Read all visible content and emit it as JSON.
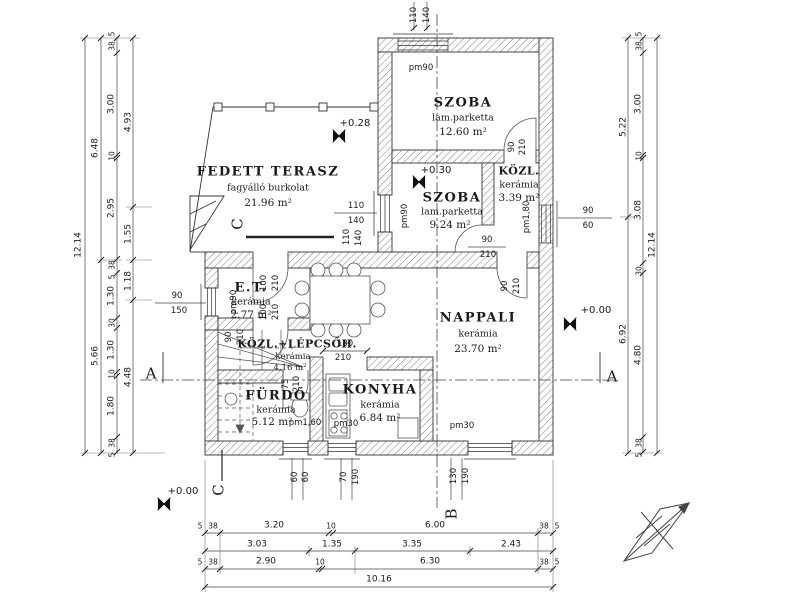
{
  "rooms": [
    {
      "name": "FEDETT TERASZ",
      "finish": "fagyálló burkolat",
      "area": "21.96 m²"
    },
    {
      "name": "SZOBA",
      "finish": "lam.parketta",
      "area": "12.60 m²"
    },
    {
      "name": "KÖZL.",
      "finish": "kerámia",
      "area": "3.39 m²"
    },
    {
      "name": "SZOBA",
      "finish": "lam.parketta",
      "area": "9.24 m²"
    },
    {
      "name": "NAPPALI",
      "finish": "kerámia",
      "area": "23.70 m²"
    },
    {
      "name": "E.T.",
      "finish": "kerámia",
      "area": "2.77 m²"
    },
    {
      "name": "KÖZL.+LÉPCSŐH.",
      "finish": "kerámia",
      "area": "4.16 m²"
    },
    {
      "name": "FÜRDŐ",
      "finish": "kerámia",
      "area": "5.12 m²"
    },
    {
      "name": "KONYHA",
      "finish": "kerámia",
      "area": "6.84 m²"
    }
  ],
  "levels": {
    "terasz": "+0.28",
    "szoba": "+0.30",
    "ground_a": "+0.00",
    "ground_b": "+0.00"
  },
  "sections": {
    "a": "A",
    "b": "B",
    "c": "C"
  },
  "dims": {
    "v_total": "12.14",
    "left2": [
      "6.48",
      "5.66"
    ],
    "left3": [
      "5",
      "38",
      "3.00",
      "10",
      "2.95",
      "38",
      "5",
      "1.30",
      "30",
      "1.30",
      "10",
      "1.80",
      "38",
      "5"
    ],
    "left4": [
      "4.93",
      "1.55",
      "1.18",
      "4.48"
    ],
    "right1": [
      "5.22",
      "6.92"
    ],
    "right2": [
      "5",
      "38",
      "3.00",
      "10",
      "3.08",
      "30",
      "4.80",
      "38",
      "5"
    ],
    "bottom1": [
      "5",
      "38",
      "3.20",
      "10",
      "6.00",
      "38",
      "5"
    ],
    "bottom2": [
      "3.03",
      "1.35",
      "3.35",
      "2.43"
    ],
    "bottom3": [
      "5",
      "38",
      "2.90",
      "10",
      "6.30",
      "38",
      "5"
    ],
    "h_total": "10.16",
    "top": [
      "110",
      "140"
    ]
  },
  "callouts": {
    "win_terasz": [
      "110",
      "140"
    ],
    "win_et": [
      "90",
      "150"
    ],
    "win_right": [
      "90",
      "60"
    ],
    "win_bath": [
      "60",
      "60"
    ],
    "win_kitchen": [
      "70",
      "190"
    ],
    "win_nappali": [
      "130",
      "190"
    ],
    "door_szoba_top": [
      "90",
      "210"
    ],
    "door_szoba_mid": [
      "90",
      "210"
    ],
    "door_kozl": [
      "90",
      "210"
    ],
    "door_stair": [
      "90",
      "210"
    ],
    "door_et_north": [
      "100",
      "210"
    ],
    "door_et_south": [
      "100",
      "210"
    ],
    "door_bath": [
      "75",
      "210"
    ],
    "pass_nappali": [
      "130",
      "210"
    ],
    "pm90": "pm90",
    "pm180": "pm1,80",
    "pm160": "pm1,60",
    "pm30": "pm30"
  },
  "colors": {
    "line": "#333333",
    "dim": "#444444",
    "paper": "#ffffff"
  }
}
